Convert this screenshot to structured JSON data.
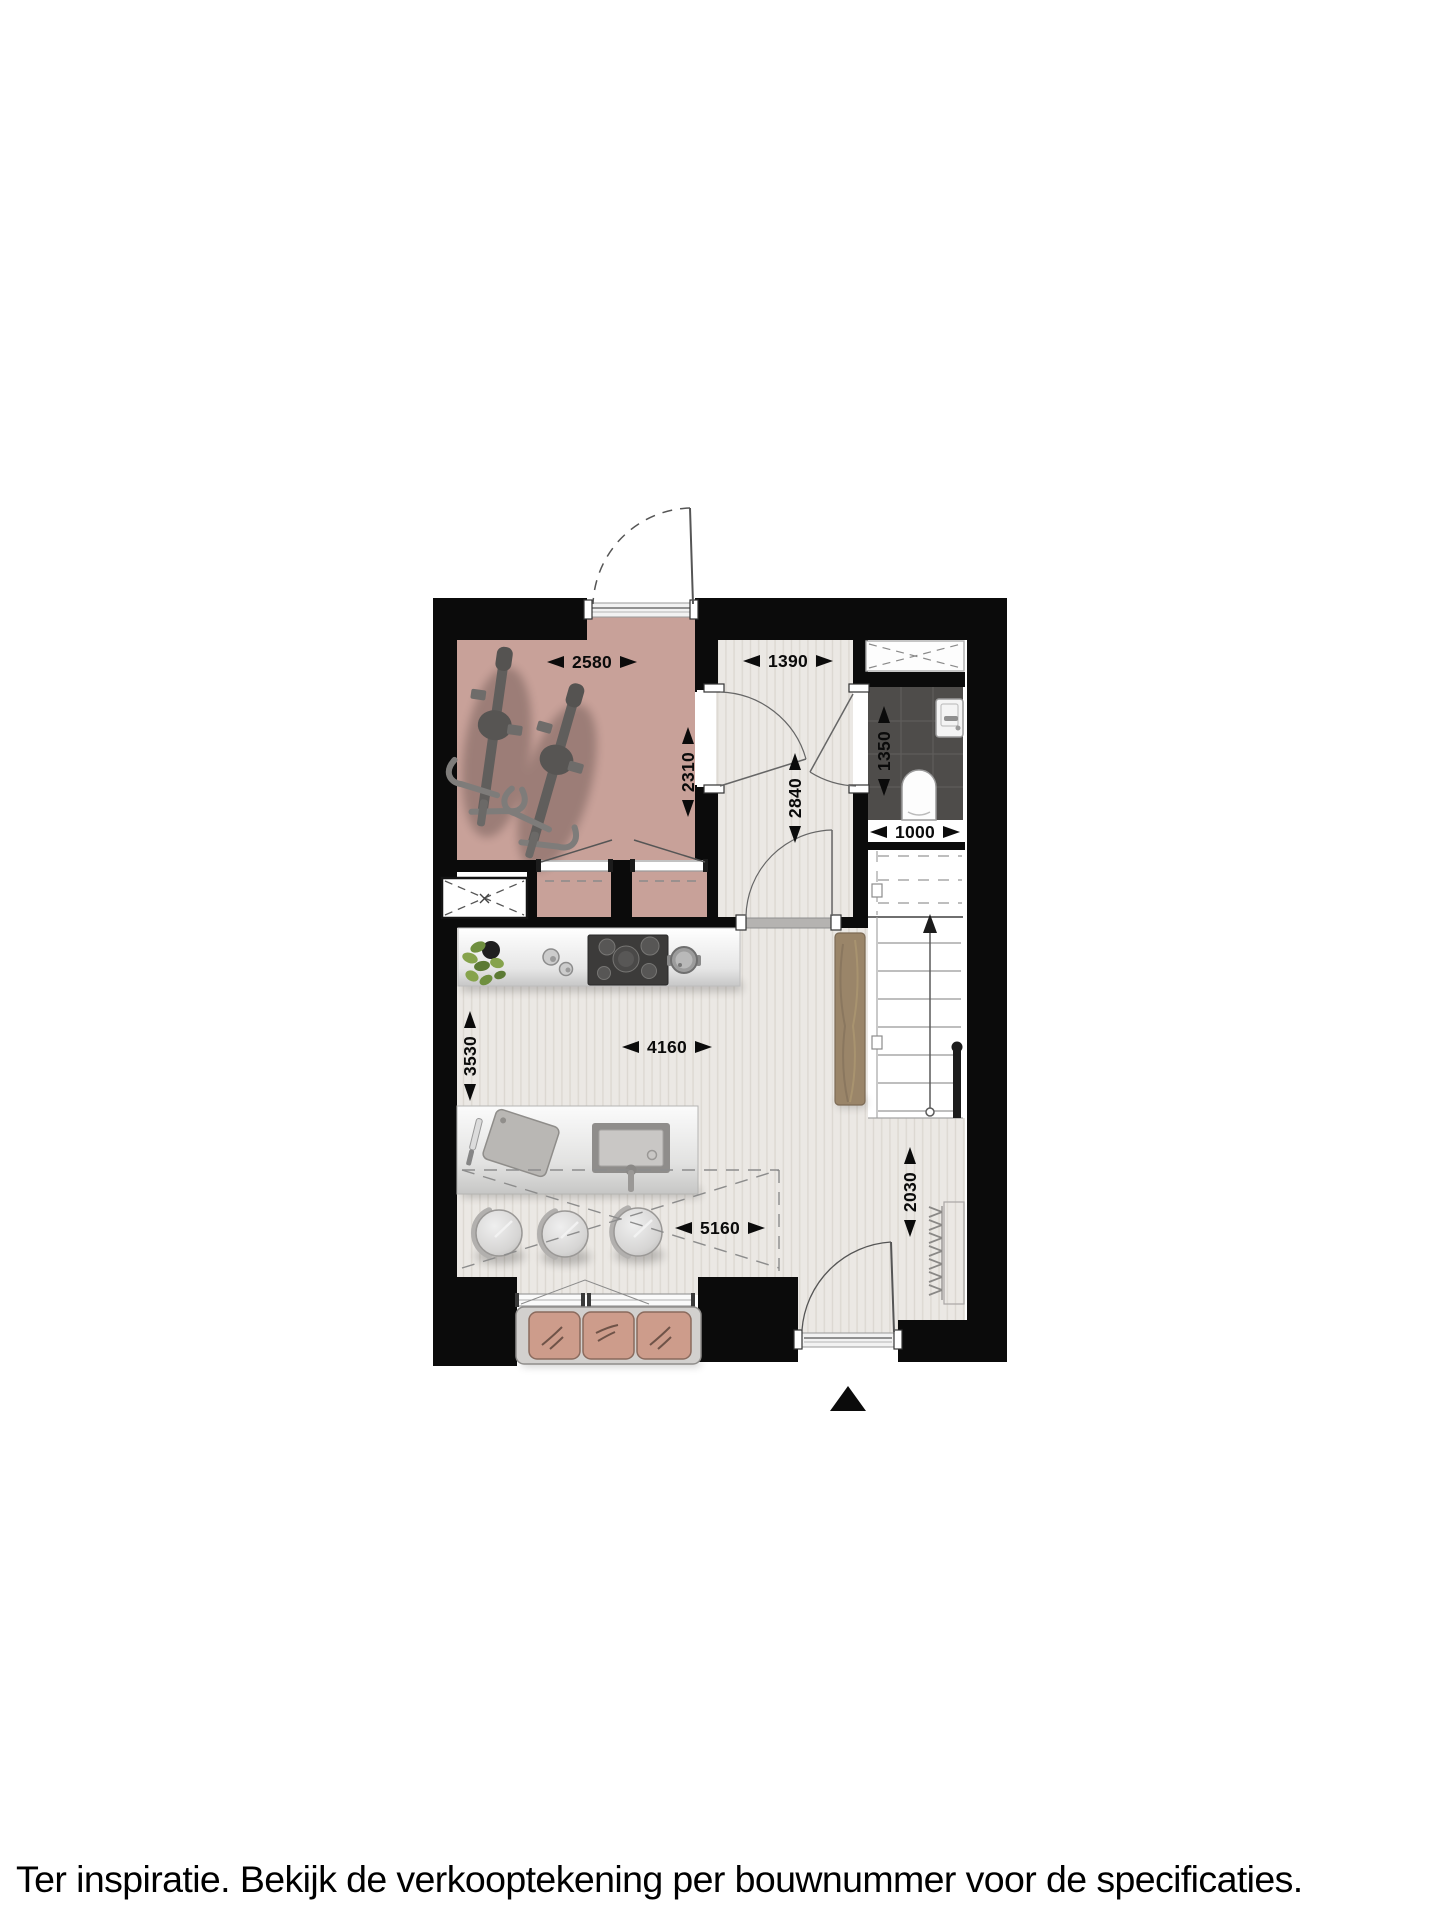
{
  "caption": "Ter inspiratie. Bekijk de verkooptekening per bouwnummer voor de specificaties.",
  "dimensions": {
    "front_room_width": "2580",
    "front_room_depth": "2310",
    "hall_width": "1390",
    "hall_depth": "2840",
    "wc_depth": "1350",
    "wc_width": "1000",
    "living_depth": "3530",
    "living_width": "4160",
    "living_diagonal": "5160",
    "entry_depth": "2030"
  },
  "icons": {
    "north_indicator": "north-arrow-triangle"
  },
  "colors": {
    "wall": "#0b0b0b",
    "front_room_floor": "#c8a199",
    "light_floor": "#ebe8e4",
    "floor_stripe": "#dcd8d2",
    "wc_floor": "#4e4c4a",
    "cushion": "#cd9c8b",
    "wood": "#9a8569"
  }
}
